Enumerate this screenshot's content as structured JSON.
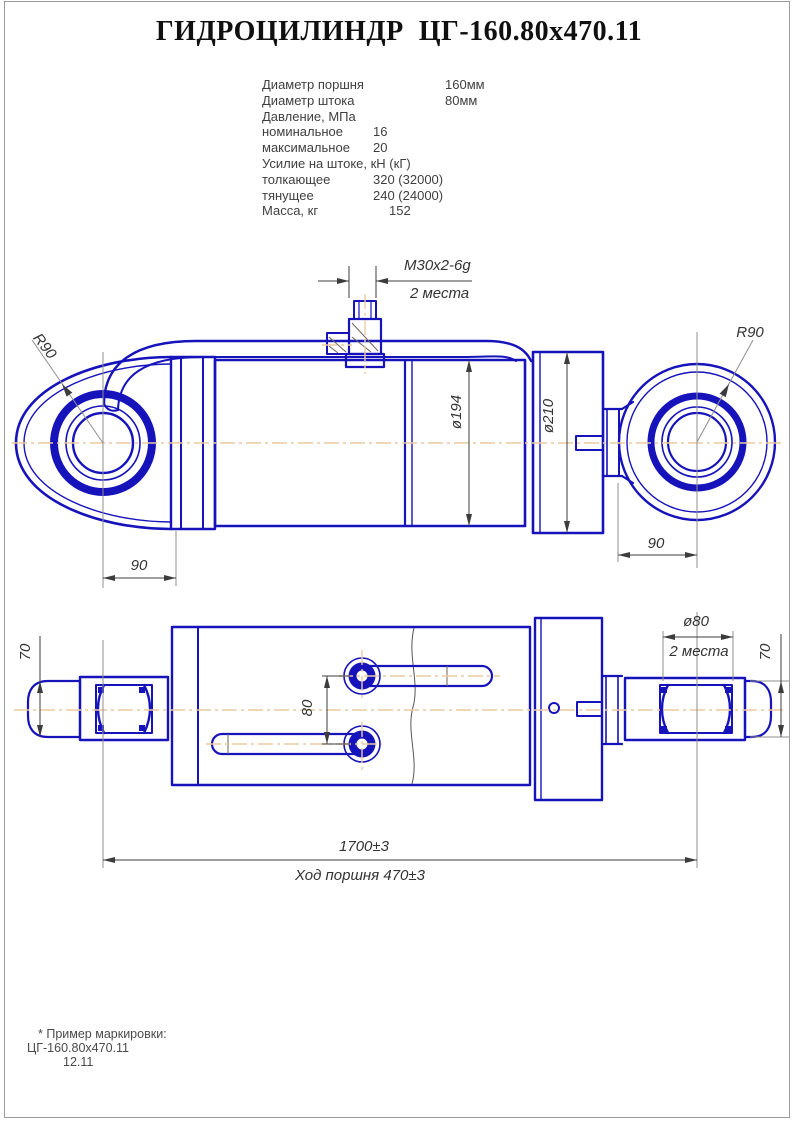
{
  "sheet": {
    "title": "ГИДРОЦИЛИНДР  ЦГ-160.80x470.11"
  },
  "specs": {
    "rows": [
      {
        "label": "Диаметр поршня",
        "value": "160мм"
      },
      {
        "label": "Диаметр штока",
        "value": "80мм"
      },
      {
        "label": "Давление, МПа",
        "value": ""
      },
      {
        "label": "номинальное",
        "value": "16"
      },
      {
        "label": "максимальное",
        "value": "20"
      },
      {
        "label": "Усилие на штоке, кН (кГ)",
        "value": ""
      },
      {
        "label": "толкающее",
        "value": "320 (32000)"
      },
      {
        "label": "тянущее",
        "value": "240 (24000)"
      },
      {
        "label": "Масса, кг",
        "value": "152"
      }
    ]
  },
  "drawing": {
    "dims": {
      "thread": "M30x2-6g",
      "thread_note": "2 места",
      "radius_left": "R90",
      "radius_right": "R90",
      "dia_body": "ø194",
      "dia_head": "ø210",
      "eye_offset_left": "90",
      "eye_offset_right": "90",
      "port_spacing": "80",
      "pin_dia": "ø80",
      "pin_dia_note": "2 места",
      "eye_width_left": "70",
      "eye_width_right": "70",
      "overall_length": "1700±3",
      "stroke_note": "Ход поршня 470±3"
    }
  },
  "footer": {
    "note_title": "* Пример маркировки:",
    "note_line1": "ЦГ-160.80x470.11",
    "note_line2": "12.11"
  },
  "colors": {
    "line_blue": "#1613bb",
    "dim_gray": "#3c3c3c",
    "centerline": "#eccaa0",
    "hatch": "#70655b"
  }
}
